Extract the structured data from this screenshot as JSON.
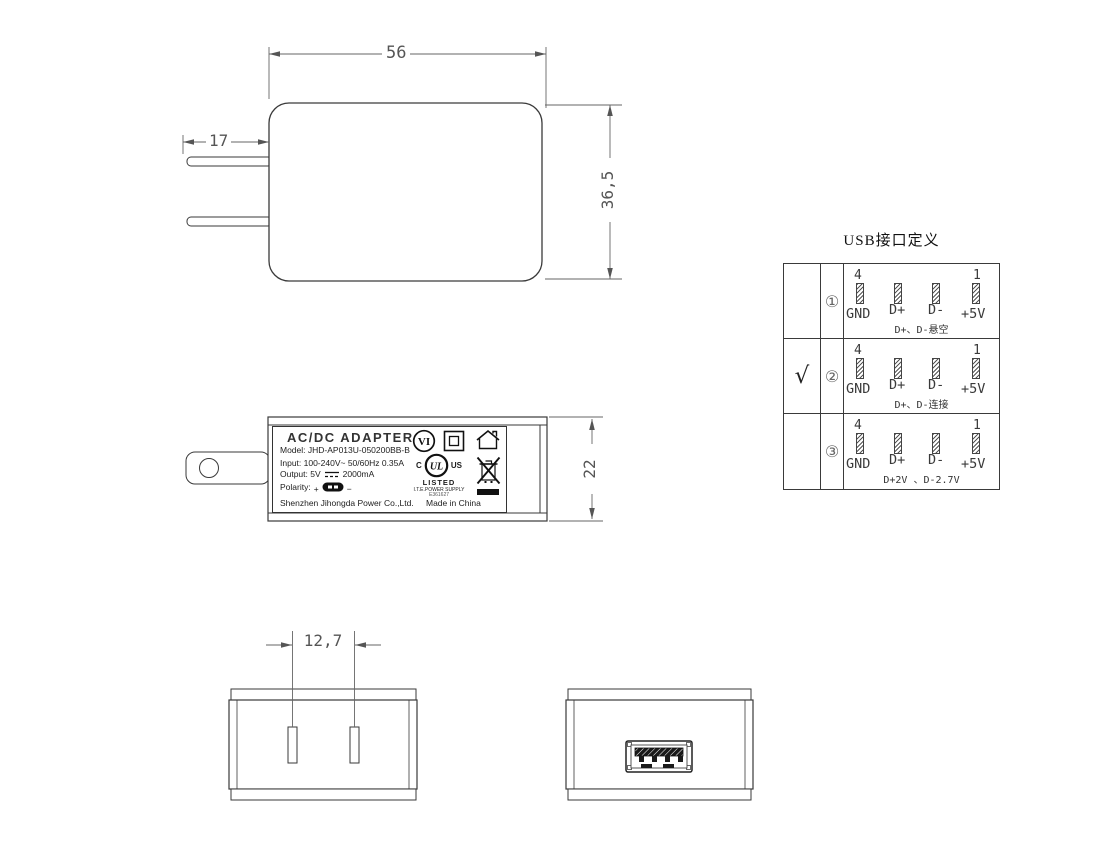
{
  "drawing": {
    "dims": {
      "front_width": "56",
      "front_height": "36,5",
      "prong_length": "17",
      "side_height": "22",
      "pin_spacing": "12,7"
    }
  },
  "label": {
    "title": "AC/DC  ADAPTER",
    "model": "Model: JHD-AP013U-050200BB-B",
    "input": "Input: 100-240V~  50/60Hz  0.35A",
    "output_prefix": "Output: 5V",
    "output_suffix": "2000mA",
    "polarity_label": "Polarity:",
    "plus": "+",
    "minus": "−",
    "manufacturer": "Shenzhen Jihongda Power Co.,Ltd.",
    "made_in": "Made in China",
    "efficiency": "VI",
    "ul_c": "C",
    "ul_us": "US",
    "ul_mark": "UL",
    "ul_listed": "LISTED",
    "ul_type": "I.T.E.POWER SUPPLY",
    "ul_file": "E361627"
  },
  "usb_table": {
    "title": "USB接口定义",
    "pin_first": "4",
    "pin_last": "1",
    "pin_labels": [
      "GND",
      "D+",
      "D-",
      "+5V"
    ],
    "rows": [
      {
        "index": "①",
        "check": "",
        "note": "D+、D-悬空"
      },
      {
        "index": "②",
        "check": "√",
        "note": "D+、D-连接"
      },
      {
        "index": "③",
        "check": "",
        "note": "D+2V 、D-2.7V"
      }
    ]
  }
}
